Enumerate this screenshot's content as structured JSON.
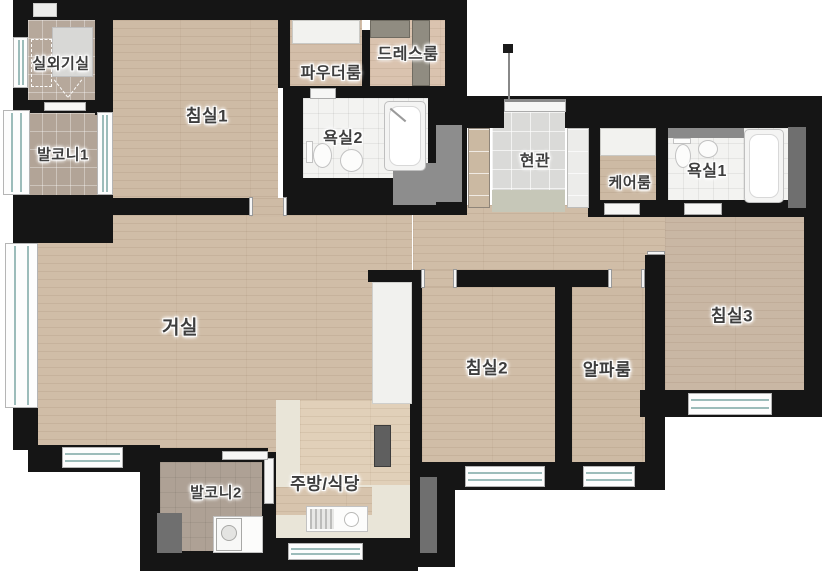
{
  "plan": {
    "title": "apartment-floor-plan",
    "rooms": [
      {
        "id": "outdoor-unit-room",
        "label": "실외기실"
      },
      {
        "id": "balcony-1",
        "label": "발코니1"
      },
      {
        "id": "bedroom-1",
        "label": "침실1"
      },
      {
        "id": "powder-room",
        "label": "파우더룸"
      },
      {
        "id": "dress-room",
        "label": "드레스룸"
      },
      {
        "id": "bathroom-2",
        "label": "욕실2"
      },
      {
        "id": "entrance",
        "label": "현관"
      },
      {
        "id": "care-room",
        "label": "케어룸"
      },
      {
        "id": "bathroom-1",
        "label": "욕실1"
      },
      {
        "id": "living-room",
        "label": "거실"
      },
      {
        "id": "bedroom-2",
        "label": "침실2"
      },
      {
        "id": "alpha-room",
        "label": "알파룸"
      },
      {
        "id": "bedroom-3",
        "label": "침실3"
      },
      {
        "id": "balcony-2",
        "label": "발코니2"
      },
      {
        "id": "kitchen-dining",
        "label": "주방/식당"
      }
    ],
    "colors": {
      "wall": "#151515",
      "window-glass": "#9cbcba",
      "duct-gray": "#6f6f6f",
      "zone-gray": "#8d8d8d",
      "label-text": "#3e3e3e",
      "wood-floor": "#cfbca6",
      "tile-balcony": "#b2a497",
      "tile-bath": "#f3f3f1",
      "tile-entrance": "#dadad8",
      "kitchen-cream": "#e9e5d8"
    }
  }
}
